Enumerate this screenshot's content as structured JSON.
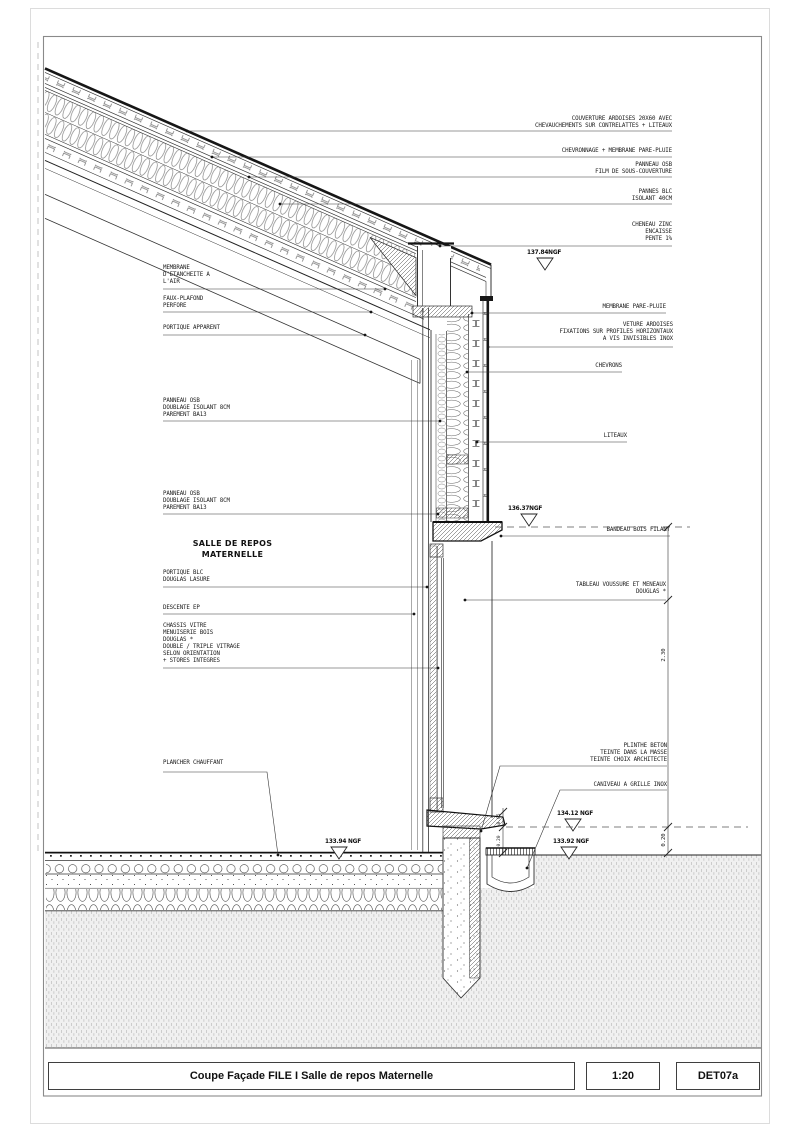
{
  "title_block": {
    "title": "Coupe Façade FILE I Salle de repos Maternelle",
    "scale": "1:20",
    "ref": "DET07a"
  },
  "drawing": {
    "room_label": {
      "lines": [
        "SALLE DE REPOS",
        "MATERNELLE"
      ]
    },
    "annotations": [
      {
        "id": "couverture",
        "side": "right",
        "rx": 672,
        "ty": 116,
        "ly": 131,
        "dot": [
          187,
          131
        ],
        "lines": [
          "COUVERTURE ARDOISES 20X60 AVEC",
          "CHEVAUCHEMENTS SUR CONTRELATTES + LITEAUX"
        ]
      },
      {
        "id": "chevronnage",
        "side": "right",
        "rx": 672,
        "ty": 148,
        "ly": 157,
        "dot": [
          212,
          157
        ],
        "lines": [
          "CHEVRONNAGE + MEMBRANE PARE-PLUIE"
        ]
      },
      {
        "id": "panneau-osb-toiture",
        "side": "right",
        "rx": 672,
        "ty": 162,
        "ly": 177,
        "dot": [
          249,
          177
        ],
        "lines": [
          "PANNEAU OSB",
          "FILM DE SOUS-COUVERTURE"
        ]
      },
      {
        "id": "pannes-blc",
        "side": "right",
        "rx": 672,
        "ty": 189,
        "ly": 204,
        "dot": [
          280,
          204
        ],
        "lines": [
          "PANNES BLC",
          "ISOLANT 40CM"
        ]
      },
      {
        "id": "cheneau",
        "side": "right",
        "rx": 672,
        "ty": 222,
        "ly": 246,
        "dot": [
          440,
          246
        ],
        "lines": [
          "CHENEAU ZINC",
          "ENCAISSE",
          "PENTE 1%"
        ]
      },
      {
        "id": "membrane-pare-pluie",
        "side": "right",
        "rx": 666,
        "ty": 304,
        "ly": 313,
        "dot": [
          472,
          313
        ],
        "lines": [
          "MEMBRANE PARE-PLUIE"
        ]
      },
      {
        "id": "veture-ardoises",
        "side": "right",
        "rx": 673,
        "ty": 322,
        "ly": 347,
        "dot": [
          488,
          347
        ],
        "lines": [
          "VETURE ARDOISES",
          "FIXATIONS SUR PROFILES HORIZONTAUX",
          "A VIS INVISIBLES INOX"
        ]
      },
      {
        "id": "chevrons",
        "side": "right",
        "rx": 622,
        "ty": 363,
        "ly": 372,
        "dot": [
          467,
          372
        ],
        "lines": [
          "CHEVRONS"
        ]
      },
      {
        "id": "liteaux",
        "side": "right",
        "rx": 627,
        "ty": 433,
        "ly": 442,
        "dot": [
          477,
          442
        ],
        "lines": [
          "LITEAUX"
        ]
      },
      {
        "id": "bandeau-bois",
        "side": "right",
        "rx": 670,
        "ty": 527,
        "ly": 536,
        "dot": [
          501,
          536
        ],
        "lines": [
          "BANDEAU BOIS FILANT"
        ]
      },
      {
        "id": "tableau-voussure",
        "side": "right",
        "rx": 666,
        "ty": 582,
        "ly": 600,
        "dot": [
          465,
          600
        ],
        "lines": [
          "TABLEAU VOUSSURE ET MENEAUX",
          "DOUGLAS *"
        ]
      },
      {
        "id": "plinthe-beton",
        "side": "right",
        "rx": 667,
        "ty": 743,
        "ly": 766,
        "bend": [
          500,
          766
        ],
        "dot": [
          481,
          831
        ],
        "lines": [
          "PLINTHE BETON",
          "TEINTE DANS LA MASSE",
          "TEINTE CHOIX ARCHITECTE"
        ]
      },
      {
        "id": "caniveau",
        "side": "right",
        "rx": 667,
        "ty": 782,
        "ly": 790,
        "bend": [
          560,
          790
        ],
        "dot": [
          527,
          868
        ],
        "lines": [
          "CANIVEAU A GRILLE INOX"
        ]
      },
      {
        "id": "membrane-etancheite",
        "side": "left",
        "lx": 163,
        "ty": 265,
        "ly": 289,
        "dot": [
          385,
          289
        ],
        "lines": [
          "MEMBRANE",
          "D'ETANCHEITE A",
          "L'AIR"
        ]
      },
      {
        "id": "faux-plafond",
        "side": "left",
        "lx": 163,
        "ty": 296,
        "ly": 312,
        "dot": [
          371,
          312
        ],
        "lines": [
          "FAUX-PLAFOND",
          "PERFORE"
        ]
      },
      {
        "id": "portique-apparent",
        "side": "left",
        "lx": 163,
        "ty": 325,
        "ly": 335,
        "dot": [
          365,
          335
        ],
        "lines": [
          "PORTIQUE APPARENT"
        ]
      },
      {
        "id": "panneau-osb-haut",
        "side": "left",
        "lx": 163,
        "ty": 398,
        "ly": 421,
        "dot": [
          440,
          421
        ],
        "lines": [
          "PANNEAU OSB",
          "DOUBLAGE ISOLANT 8CM",
          "PAREMENT BA13"
        ]
      },
      {
        "id": "panneau-osb-bas",
        "side": "left",
        "lx": 163,
        "ty": 491,
        "ly": 514,
        "dot": [
          438,
          514
        ],
        "lines": [
          "PANNEAU OSB",
          "DOUBLAGE ISOLANT 8CM",
          "PAREMENT BA13"
        ]
      },
      {
        "id": "portique-blc",
        "side": "left",
        "lx": 163,
        "ty": 570,
        "ly": 587,
        "dot": [
          427,
          587
        ],
        "lines": [
          "PORTIQUE BLC",
          "DOUGLAS LASURE"
        ]
      },
      {
        "id": "descente-ep",
        "side": "left",
        "lx": 163,
        "ty": 605,
        "ly": 614,
        "dot": [
          414,
          614
        ],
        "lines": [
          "DESCENTE EP"
        ]
      },
      {
        "id": "chassis-vitre",
        "side": "left",
        "lx": 163,
        "ty": 623,
        "ly": 668,
        "dot": [
          438,
          668
        ],
        "lines": [
          "CHASSIS VITRE",
          "MENUISERIE BOIS",
          "DOUGLAS *",
          "DOUBLE / TRIPLE VITRAGE",
          "SELON ORIENTATION",
          "+ STORES INTEGRES"
        ]
      },
      {
        "id": "plancher-chauffant",
        "side": "left",
        "lx": 163,
        "ty": 760,
        "ly": 772,
        "bend": [
          267,
          772
        ],
        "dot": [
          278,
          855
        ],
        "lines": [
          "PLANCHER CHAUFFANT"
        ]
      }
    ],
    "levels": [
      {
        "id": "ngf-137-84",
        "text": "137.84NGF",
        "x": 527,
        "ty": 250,
        "tri": [
          545,
          258
        ]
      },
      {
        "id": "ngf-136-37",
        "text": "136.37NGF",
        "x": 508,
        "ty": 506,
        "tri": [
          529,
          514
        ]
      },
      {
        "id": "ngf-134-12",
        "text": "134.12 NGF",
        "x": 557,
        "ty": 811,
        "tri": [
          573,
          819
        ]
      },
      {
        "id": "ngf-133-92",
        "text": "133.92 NGF",
        "x": 553,
        "ty": 839,
        "tri": [
          569,
          847
        ]
      },
      {
        "id": "ngf-133-94",
        "text": "133.94 NGF",
        "x": 325,
        "ty": 839,
        "tri": [
          339,
          847
        ]
      }
    ],
    "dimensions": [
      {
        "id": "dim-right",
        "x": 668,
        "y1": 527,
        "y2": 853,
        "ticks": [
          527,
          600,
          827,
          853
        ],
        "fs": 5.5,
        "labels": [
          {
            "text": "2.30",
            "y": 655
          },
          {
            "text": "0.20",
            "y": 840
          }
        ]
      },
      {
        "id": "dim-left",
        "x": 503,
        "y1": 808,
        "y2": 855,
        "ticks": [
          812,
          827,
          853
        ],
        "fs": 4.6,
        "labels": [
          {
            "text": "0.05",
            "y": 819
          },
          {
            "text": "0.20",
            "y": 841
          }
        ]
      }
    ],
    "level_dashes": [
      {
        "y": 527,
        "x1": 495,
        "x2": 690
      },
      {
        "y": 827,
        "x1": 506,
        "x2": 748
      }
    ]
  },
  "colors": {
    "line": "#333333",
    "dark": "#161616",
    "text": "#1c1c1c",
    "frame": "#8a8a8a",
    "earth": "#efefef"
  }
}
